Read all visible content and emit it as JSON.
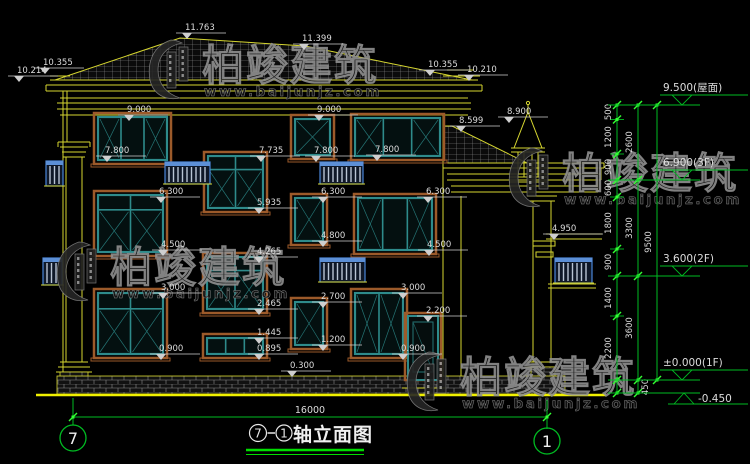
{
  "colors": {
    "line_yellow": "#d6d630",
    "bright_yellow": "#f0f000",
    "annot_green": "#00bb22",
    "tick_green": "#33ff33",
    "text_white": "#dcdcdc",
    "frame_teal": "#2e8b8b",
    "surround_brown": "#9c5a2a",
    "railing_blue": "#4a86d8",
    "watermark_gray": "#8f8f8f"
  },
  "watermark": {
    "brand": "柏竣建筑",
    "url": "www.baijunjz.com",
    "instances": [
      {
        "x": 145,
        "y": 38
      },
      {
        "x": 505,
        "y": 146
      },
      {
        "x": 53,
        "y": 240
      },
      {
        "x": 403,
        "y": 350
      }
    ]
  },
  "facade_labels": [
    {
      "t": "11.763",
      "x": 184,
      "y": 33
    },
    {
      "t": "11.399",
      "x": 301,
      "y": 44
    },
    {
      "t": "10.214",
      "x": 16,
      "y": 76
    },
    {
      "t": "10.355",
      "x": 42,
      "y": 68
    },
    {
      "t": "10.355",
      "x": 427,
      "y": 70
    },
    {
      "t": "10.210",
      "x": 466,
      "y": 75
    },
    {
      "t": "9.000",
      "x": 126,
      "y": 115
    },
    {
      "t": "9.000",
      "x": 316,
      "y": 115
    },
    {
      "t": "8.900",
      "x": 506,
      "y": 117
    },
    {
      "t": "8.599",
      "x": 458,
      "y": 126
    },
    {
      "t": "7.800",
      "x": 104,
      "y": 156
    },
    {
      "t": "7.735",
      "x": 258,
      "y": 156
    },
    {
      "t": "7.800",
      "x": 313,
      "y": 156
    },
    {
      "t": "7.800",
      "x": 374,
      "y": 155
    },
    {
      "t": "6.300",
      "x": 158,
      "y": 197
    },
    {
      "t": "6.300",
      "x": 320,
      "y": 197
    },
    {
      "t": "6.300",
      "x": 425,
      "y": 197
    },
    {
      "t": "5.935",
      "x": 256,
      "y": 208
    },
    {
      "t": "4.800",
      "x": 320,
      "y": 241
    },
    {
      "t": "4.500",
      "x": 160,
      "y": 250
    },
    {
      "t": "4.500",
      "x": 426,
      "y": 250
    },
    {
      "t": "4.265",
      "x": 256,
      "y": 257
    },
    {
      "t": "4.950",
      "x": 551,
      "y": 234,
      "len": 52
    },
    {
      "t": "3.000",
      "x": 160,
      "y": 293
    },
    {
      "t": "3.000",
      "x": 400,
      "y": 293
    },
    {
      "t": "2.700",
      "x": 320,
      "y": 302
    },
    {
      "t": "2.465",
      "x": 256,
      "y": 309
    },
    {
      "t": "2.200",
      "x": 425,
      "y": 316
    },
    {
      "t": "1.445",
      "x": 256,
      "y": 338
    },
    {
      "t": "1.200",
      "x": 320,
      "y": 345
    },
    {
      "t": "0.900",
      "x": 158,
      "y": 354
    },
    {
      "t": "0.895",
      "x": 256,
      "y": 354
    },
    {
      "t": "0.900",
      "x": 400,
      "y": 354
    },
    {
      "t": "0.300",
      "x": 289,
      "y": 371
    }
  ],
  "windows": [
    {
      "x": 98,
      "y": 117,
      "w": 69,
      "h": 43,
      "cols": 3,
      "transom": false,
      "xp": [
        0,
        2
      ]
    },
    {
      "x": 208,
      "y": 156,
      "w": 55,
      "h": 52,
      "cols": 2,
      "transom": true,
      "xp": [
        0,
        1
      ]
    },
    {
      "x": 295,
      "y": 119,
      "w": 35,
      "h": 36,
      "cols": 1,
      "transom": false,
      "xp": [
        0
      ]
    },
    {
      "x": 355,
      "y": 118,
      "w": 85,
      "h": 38,
      "cols": 3,
      "transom": false,
      "xp": [
        0,
        2
      ]
    },
    {
      "x": 98,
      "y": 195,
      "w": 65,
      "h": 57,
      "cols": 2,
      "transom": true,
      "xp": [
        0,
        1
      ]
    },
    {
      "x": 207,
      "y": 257,
      "w": 56,
      "h": 52,
      "cols": 2,
      "transom": true,
      "xp": [
        0,
        1
      ]
    },
    {
      "x": 295,
      "y": 198,
      "w": 28,
      "h": 43,
      "cols": 1,
      "transom": false,
      "xp": [
        0
      ]
    },
    {
      "x": 358,
      "y": 198,
      "w": 74,
      "h": 52,
      "cols": 3,
      "transom": false,
      "xp": [
        0,
        2
      ]
    },
    {
      "x": 98,
      "y": 293,
      "w": 65,
      "h": 61,
      "cols": 2,
      "transom": true,
      "xp": [
        0,
        1
      ]
    },
    {
      "x": 207,
      "y": 338,
      "w": 56,
      "h": 16,
      "cols": 3,
      "transom": false,
      "xp": []
    },
    {
      "x": 295,
      "y": 302,
      "w": 28,
      "h": 43,
      "cols": 1,
      "transom": false,
      "xp": [
        0
      ]
    },
    {
      "x": 355,
      "y": 293,
      "w": 48,
      "h": 61,
      "cols": 2,
      "transom": false,
      "xp": [
        0,
        1
      ]
    },
    {
      "x": 408,
      "y": 316,
      "w": 30,
      "h": 64,
      "type": "door"
    }
  ],
  "balconies": [
    {
      "x": 46,
      "y": 161,
      "w": 17,
      "h": 25
    },
    {
      "x": 165,
      "y": 162,
      "w": 45,
      "h": 22
    },
    {
      "x": 320,
      "y": 162,
      "w": 43,
      "h": 22
    },
    {
      "x": 43,
      "y": 258,
      "w": 19,
      "h": 27
    },
    {
      "x": 320,
      "y": 258,
      "w": 45,
      "h": 24
    },
    {
      "x": 555,
      "y": 258,
      "w": 37,
      "h": 25
    }
  ],
  "chain": {
    "verticals": [
      {
        "x": 617,
        "y1": 105,
        "y2": 393
      },
      {
        "x": 638,
        "y1": 105,
        "y2": 393
      },
      {
        "x": 657,
        "y1": 105,
        "y2": 380
      }
    ],
    "ticks": [
      {
        "x": 617,
        "ys": [
          105,
          119.5,
          154,
          180,
          197,
          249,
          276,
          316,
          380,
          393
        ]
      },
      {
        "x": 638,
        "ys": [
          105,
          180,
          276,
          380,
          393
        ]
      },
      {
        "x": 657,
        "ys": [
          105,
          380
        ]
      }
    ],
    "labels": [
      {
        "t": "500",
        "x": 611,
        "y": 112
      },
      {
        "t": "1200",
        "x": 611,
        "y": 137
      },
      {
        "t": "900",
        "x": 611,
        "y": 167
      },
      {
        "t": "600",
        "x": 611,
        "y": 188
      },
      {
        "t": "1800",
        "x": 611,
        "y": 223
      },
      {
        "t": "900",
        "x": 611,
        "y": 262
      },
      {
        "t": "1400",
        "x": 611,
        "y": 298
      },
      {
        "t": "2200",
        "x": 611,
        "y": 348
      },
      {
        "t": "2600",
        "x": 632,
        "y": 142
      },
      {
        "t": "3300",
        "x": 632,
        "y": 228
      },
      {
        "t": "3600",
        "x": 632,
        "y": 328
      },
      {
        "t": "9500",
        "x": 651,
        "y": 242
      },
      {
        "t": "450",
        "x": 648,
        "y": 387
      }
    ]
  },
  "levels": [
    {
      "label": "9.500(屋面)",
      "y": 105
    },
    {
      "label": "6.900(3F)",
      "y": 180
    },
    {
      "label": "3.600(2F)",
      "y": 276
    },
    {
      "label": "±0.000(1F)",
      "y": 380
    },
    {
      "label": "-0.450",
      "y": 393,
      "inv": true
    }
  ],
  "bottom": {
    "dim": "16000",
    "axis_left": "7",
    "axis_right": "1"
  },
  "title": {
    "left_bubble": "7",
    "right_bubble": "1",
    "name": "轴立面图"
  }
}
